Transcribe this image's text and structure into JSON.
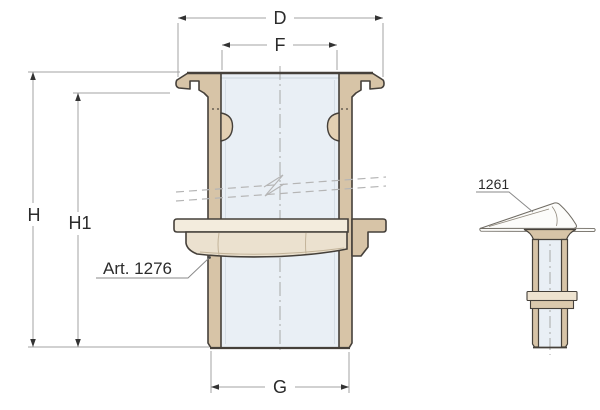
{
  "figure": {
    "type": "technical-drawing",
    "subject": "through-hull skin fitting cross-section with scoop strainer side view",
    "main_view": {
      "article_label": "Art. 1276",
      "dimensions": {
        "flange_outer_diameter": "D",
        "bore_inner_diameter": "F",
        "total_height": "H",
        "height_below_flange": "H1",
        "thread_outer_diameter": "G"
      }
    },
    "side_view": {
      "article_label": "1261"
    },
    "colors": {
      "brass_section": "#d7c4a7",
      "brass_lug": "#e2cfb2",
      "nut_face": "#ebe1cf",
      "washer_face": "#f3ecdd",
      "bore_fill": "#e9eff5",
      "outline": "#45403a",
      "dimension_line": "#a3a3a3",
      "arrowhead": "#333333",
      "break_line": "#b5b5b5",
      "scoop_outline": "#6f6b63",
      "text": "#2b2b2b",
      "background": "#ffffff"
    }
  }
}
